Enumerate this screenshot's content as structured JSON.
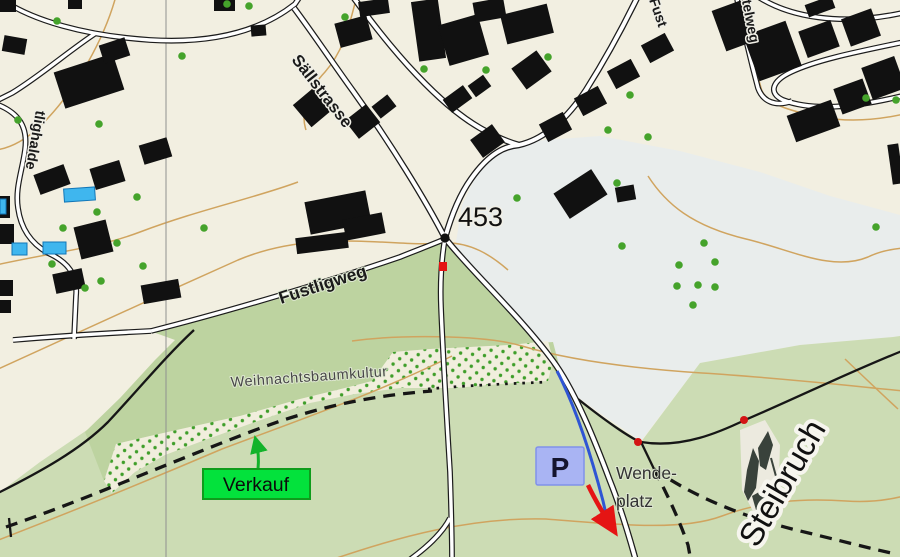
{
  "map": {
    "labels": {
      "spot_height": "453",
      "street_saellstrasse": "Sällstrasse",
      "street_fustligweg": "Fustligweg",
      "street_fust_partial": "Fust",
      "street_ttelweg_partial": "ttelweg",
      "street_tlighalde_partial": "tlighalde",
      "area_plantation": "Weihnachtsbaumkultur",
      "area_quarry": "Steibruch",
      "wendeplatz_line1": "Wende-",
      "wendeplatz_line2": "platz"
    },
    "markers": {
      "sale_label": "Verkauf",
      "parking_label": "P"
    },
    "colors": {
      "background_cream": "#f2efe1",
      "open_field": "#e9edec",
      "meadow_light": "#ccdcb4",
      "meadow_medium": "#bdd3a0",
      "plantation_bg": "#f1eedd",
      "road_fill": "#ffffff",
      "road_casing": "#1c1c1c",
      "building": "#111111",
      "contour": "#d0a45f",
      "tree_green": "#45a32b",
      "sale_box_green": "#03e23c",
      "sale_box_border": "#0f9c1c",
      "parking_blue": "#a9b4f3",
      "parking_border": "#8091ea",
      "route_blue": "#2f55d4",
      "arrow_red": "#e51414",
      "marker_red": "#d31414",
      "water_blue": "#3fb6ee",
      "grid_gray": "#909090",
      "path_black": "#161616"
    }
  }
}
